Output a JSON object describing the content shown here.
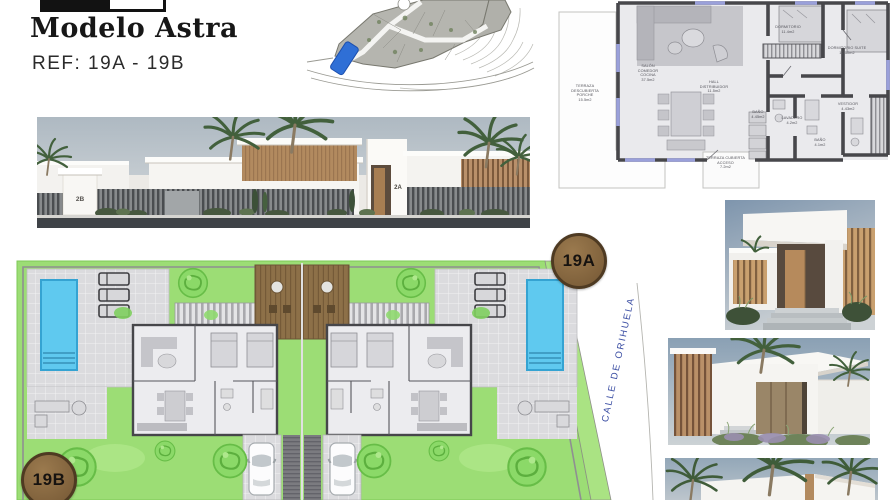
{
  "header": {
    "title": "Modelo Astra",
    "ref": "REF: 19A - 19B"
  },
  "elevation": {
    "unit_left_label": "2B",
    "unit_right_label": "2A"
  },
  "floor_plan": {
    "rooms": {
      "terraza_descubierta": "TERRAZA\nDESCUBIERTA\nPORCHE\n15.5m2",
      "salon": "SALÓN\nCOMEDOR\nCOCINA\n37.5m2",
      "hall": "HALL\nDISTRIBUIDOR\n11.5m2",
      "dormitorio": "DORMITORIO\n11.4m2",
      "dormitorio_suite": "DORMITORIO SUITE\n12.50m2",
      "bano": "BAÑO\n4.45m2",
      "lavadero": "LAVADERO\n4.2m2",
      "vestidor": "VESTIDOR\n4.43m2",
      "bano_suite": "BAÑO\n4.1m2",
      "terraza_cubierta": "TERRAZA CUBIERTA\nACCESO\n7.2m2"
    }
  },
  "site_plan": {
    "badge_a": "19A",
    "badge_b": "19B",
    "street_name": "CALLE DE ORIHUELA"
  },
  "colors": {
    "badge_fill": "#8d6a41",
    "badge_border": "#4e3a22",
    "street_text": "#3b4ea3",
    "pool": "#5fc9ef",
    "lawn": "#9cdd75",
    "deck": "#8d7048",
    "plan_wall": "#47474b",
    "location_highlight": "#2f6fd6"
  }
}
